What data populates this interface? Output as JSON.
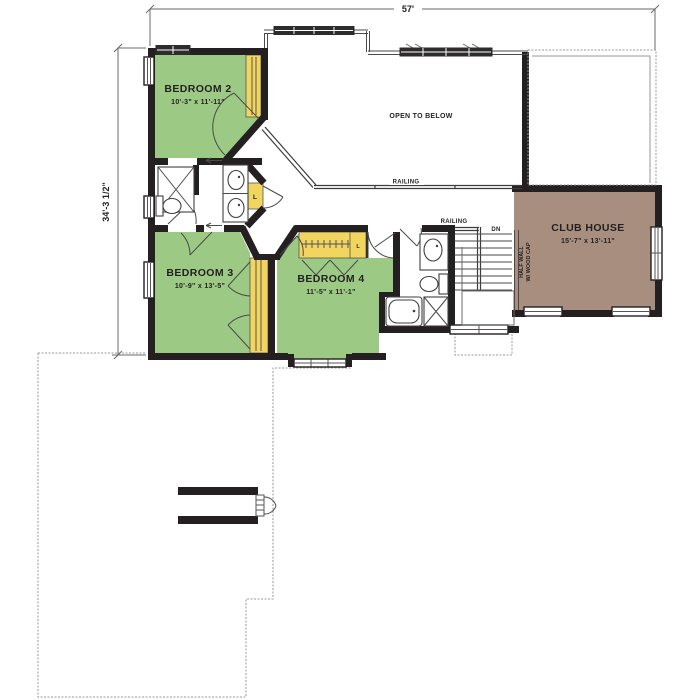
{
  "plan_title": "Second Floor Plan",
  "dimensions": {
    "width_total": "57'",
    "height_total": "34'-3 1/2\""
  },
  "rooms": {
    "bedroom2": {
      "name": "BEDROOM 2",
      "size": "10'-3\" x 11'-11\""
    },
    "bedroom3": {
      "name": "BEDROOM 3",
      "size": "10'-9\" x 13'-5\""
    },
    "bedroom4": {
      "name": "BEDROOM 4",
      "size": "11'-5\" x 11'-1\""
    },
    "club_house": {
      "name": "CLUB HOUSE",
      "size": "15'-7\" x 13'-11\""
    },
    "open_to_below": {
      "name": "OPEN TO BELOW"
    }
  },
  "labels": {
    "railing_open": "RAILING",
    "railing_stairs": "RAILING",
    "stairs_down": "DN",
    "half_wall_line1": "HALF WALL",
    "half_wall_line2": "W/ WOOD CAP",
    "linen_l": "L",
    "closet_l": "L"
  },
  "colors": {
    "bedroom_fill": "#9cca84",
    "closet_fill": "#f2d55f",
    "club_house_fill": "#a78e7e",
    "wall": "#241f21",
    "outline_gray": "#9a9a9a"
  }
}
